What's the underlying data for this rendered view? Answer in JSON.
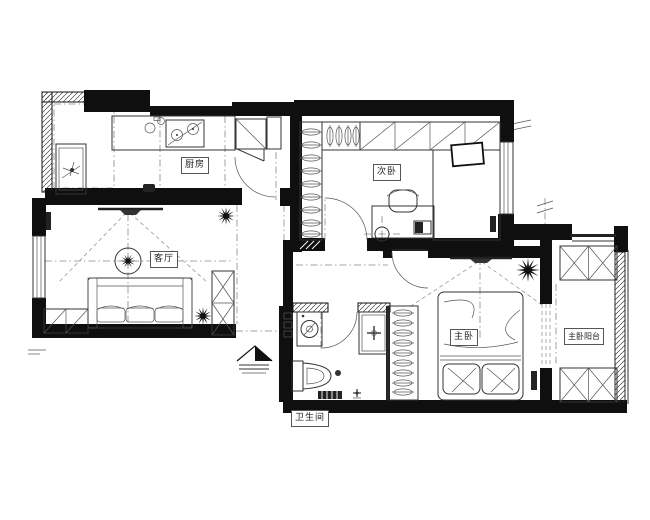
{
  "floorplan": {
    "rooms": [
      {
        "id": "kitchen",
        "label": "厨房"
      },
      {
        "id": "secondary-bedroom",
        "label": "次卧"
      },
      {
        "id": "living-room",
        "label": "客厅"
      },
      {
        "id": "master-bedroom",
        "label": "主卧"
      },
      {
        "id": "master-balcony",
        "label": "主卧阳台"
      },
      {
        "id": "bathroom",
        "label": "卫生间"
      }
    ],
    "symbols": [
      "entry-arrow",
      "door-swing",
      "window",
      "wardrobe-hangers",
      "double-bed",
      "tatami-bed",
      "desk-and-chair",
      "sofa",
      "tv",
      "ceiling-lamp",
      "plant",
      "fridge",
      "gas-stove",
      "kitchen-sink",
      "laundry-sink",
      "washing-machine",
      "toilet",
      "wash-basin",
      "x-storage-cabinet",
      "shoe-cabinet"
    ],
    "colors": {
      "wall": "#0f0f0f",
      "line": "#333333",
      "background": "#ffffff",
      "hatch": "#555555"
    }
  }
}
